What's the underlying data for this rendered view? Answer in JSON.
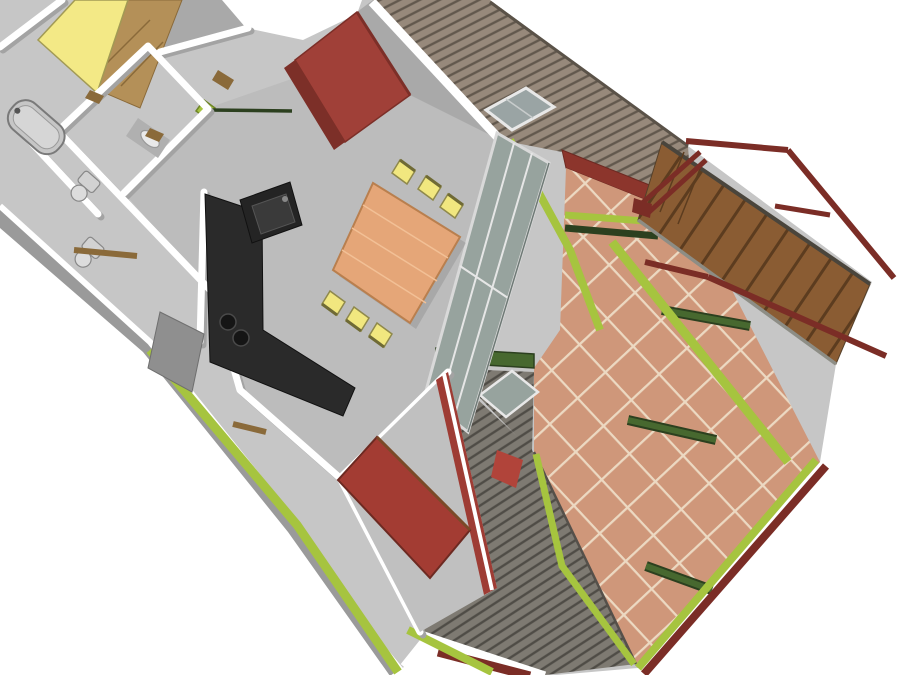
{
  "meta": {
    "type": "3d-architectural-rendering",
    "description": "Axonometric 3D cutaway floor plan of an apartment with furnished rooms, glazed living-room wall, large terracotta-tiled terrace with lime-green structural beams, pergola cross-beams and an exterior wooden staircase with maroon handrails.",
    "visible_text": ""
  },
  "palette": {
    "background": "#ffffff",
    "floor": "#c6c6c6",
    "floor_dark": "#bcbcbc",
    "floor_dark2": "#c0c0c0",
    "wall_white": "#ffffff",
    "wall_face": "#a9a9a9",
    "wall_side": "#9a9a9a",
    "wall_shadow": "#a3a3a3",
    "tile": "#cf977a",
    "tile_grout": "#ecd9c2",
    "roof_top": "#97897b",
    "roof_bottom": "#7e7a72",
    "roof_edge": "#5a5248",
    "stair_wood": "#8a5c33",
    "stair_wood_dark": "#5c3c1f",
    "lime": "#a6c43f",
    "dark_green": "#47682f",
    "dark_green_edge": "#2c401f",
    "maroon": "#7b2d26",
    "maroon_wall": "#8c352c",
    "accent_wall_red": "#9e3c34",
    "sofa_red": "#a04038",
    "bed_red": "#a33c33",
    "bed_yellow": "#f3e986",
    "wardrobe_tan": "#b49058",
    "chair_yellow": "#f1e77f",
    "table_wood": "#e5a678",
    "kitchen_black": "#2a2a2a",
    "glass": "#97a39e",
    "glass_sky": "#9aa4a4",
    "threshold_brown": "#8a6a3a"
  },
  "scene": {
    "rooms": [
      "bedroom-1",
      "bathroom",
      "hallway",
      "kitchen",
      "living-dining-room",
      "bedroom-2",
      "terrace"
    ],
    "furniture": [
      "yellow-double-bed",
      "tan-wardrobe",
      "bathtub",
      "toilet",
      "bidet",
      "washbasin",
      "red-sofa",
      "dining-table",
      "dining-chairs",
      "kitchen-counter",
      "sink",
      "cooktop",
      "red-bed"
    ],
    "exterior": [
      "slatted-roof-with-skylight",
      "lower-roof-with-skylight",
      "glazed-wall",
      "tiled-terrace",
      "lime-green-beams",
      "pergola-cross-beams",
      "wooden-staircase",
      "maroon-handrails"
    ],
    "dining_chair_count": 6,
    "skylight_count": 2,
    "pergola_beam_count": 4
  }
}
